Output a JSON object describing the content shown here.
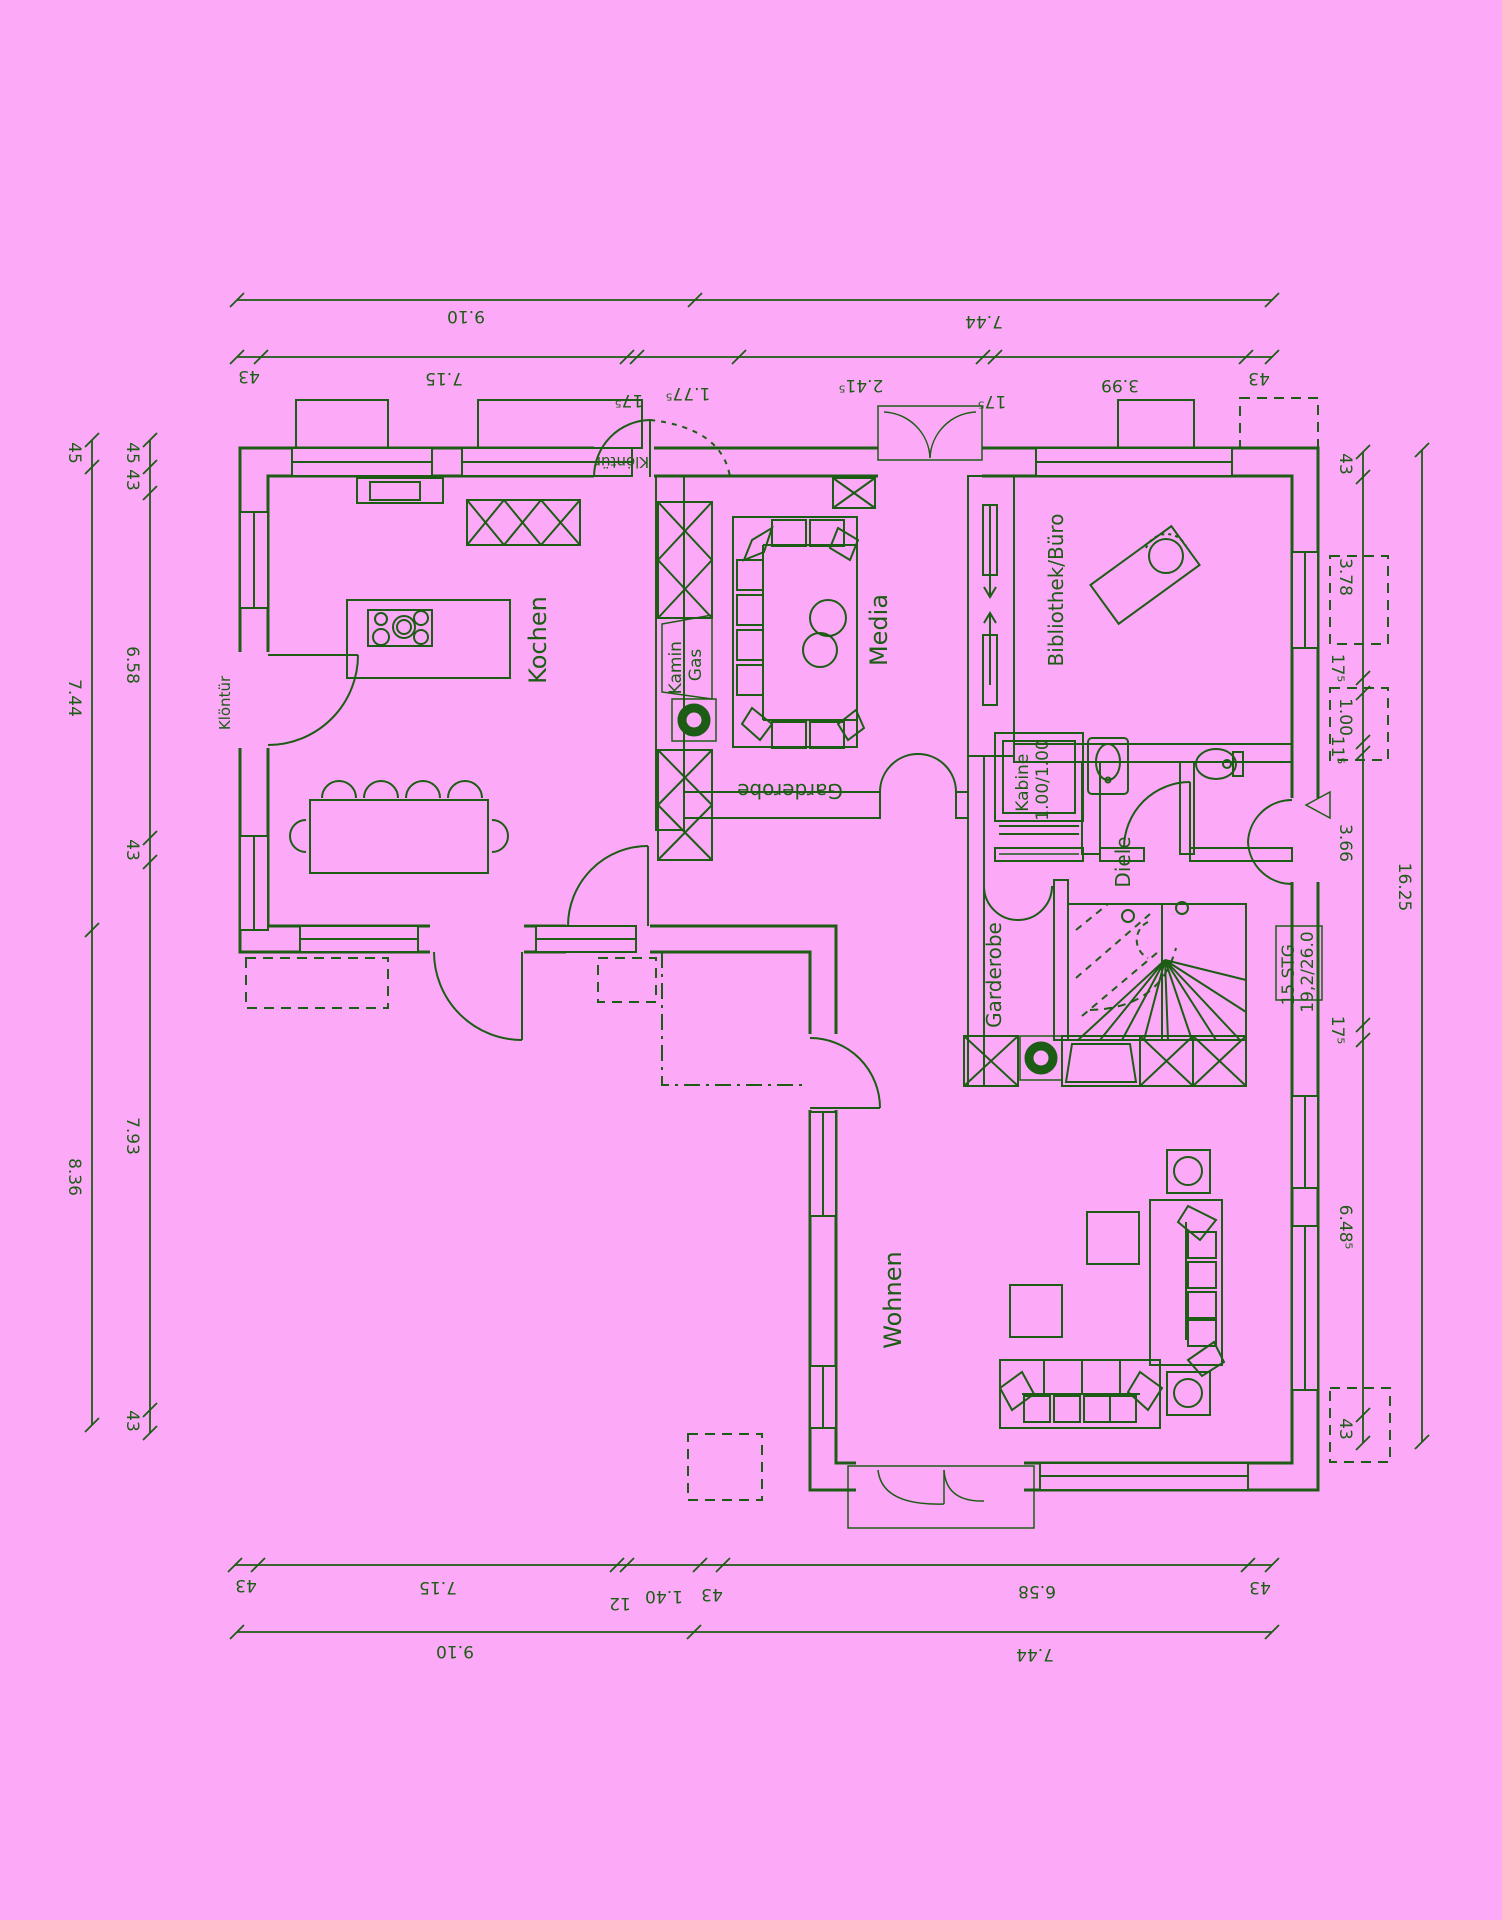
{
  "palette": {
    "background": "#fcaaf8",
    "ink": "#1d5c15"
  },
  "rooms": {
    "kochen": "Kochen",
    "media": "Media",
    "bibliothek": "Bibliothek/Büro",
    "diele": "Diele",
    "wohnen": "Wohnen",
    "garderobe_media": "Garderobe",
    "garderobe_diele": "Garderobe"
  },
  "features": {
    "kamin_line1": "Kamin",
    "kamin_line2": "Gas",
    "kabine_line1": "Kabine",
    "kabine_line2": "1.00/1.00",
    "stairs_line1": "15 STG",
    "stairs_line2": "19,2/26.0",
    "kloentuer_top": "Klöntür",
    "kloentuer_left": "Klöntür"
  },
  "dims": {
    "top_outer": [
      "9.10",
      "7.44"
    ],
    "top_inner": [
      "43",
      "7.15",
      "17⁵",
      "1.77⁵",
      "2.41⁵",
      "17⁵",
      "3.99",
      "43"
    ],
    "bottom_inner": [
      "43",
      "7.15",
      "12",
      "1.40",
      "43",
      "6.58",
      "43"
    ],
    "bottom_outer": [
      "9.10",
      "7.44"
    ],
    "left_outer": [
      "45",
      "7.44",
      "8.36"
    ],
    "left_inner": [
      "45",
      "43",
      "6.58",
      "43",
      "7.93",
      "43"
    ],
    "right_inner": [
      "43",
      "3.78",
      "17⁵",
      "1.00",
      "11⁵",
      "3.66",
      "17⁵",
      "6.48⁵",
      "43"
    ],
    "right_outer": [
      "16.25"
    ]
  }
}
